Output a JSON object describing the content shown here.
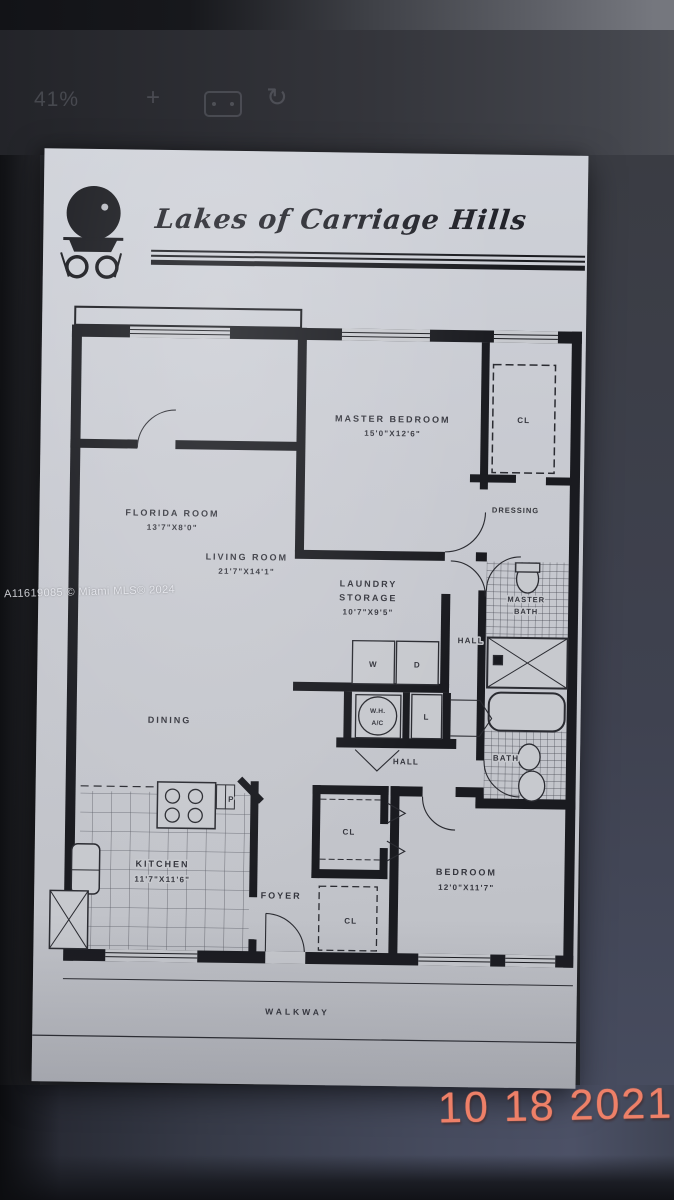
{
  "viewer_toolbar": {
    "zoom_level": "41%",
    "zoom_in_glyph": "+",
    "rotate_glyph": "↻"
  },
  "floorplan": {
    "community": "Lakes of Carriage Hills",
    "watermark": "A11619085 © Miami MLS® 2024",
    "rooms": {
      "florida": {
        "name": "FLORIDA ROOM",
        "dims": "13'7\"X8'0\""
      },
      "master_bedroom": {
        "name": "MASTER BEDROOM",
        "dims": "15'0\"X12'6\""
      },
      "living": {
        "name": "LIVING ROOM",
        "dims": "21'7\"X14'1\""
      },
      "laundry": {
        "line1": "LAUNDRY",
        "line2": "STORAGE",
        "dims": "10'7\"X9'5\""
      },
      "dining": {
        "name": "DINING"
      },
      "kitchen": {
        "name": "KITCHEN",
        "dims": "11'7\"X11'6\""
      },
      "bedroom": {
        "name": "BEDROOM",
        "dims": "12'0\"X11'7\""
      },
      "foyer": {
        "name": "FOYER"
      },
      "dressing": {
        "name": "DRESSING"
      },
      "master_bath": {
        "line1": "MASTER",
        "line2": "BATH"
      },
      "bath": {
        "name": "BATH"
      },
      "hall_upper": "HALL",
      "hall_lower": "HALL",
      "walkway": "WALKWAY"
    },
    "labels": {
      "closet": "CL",
      "washer": "W",
      "dryer": "D",
      "linen": "L",
      "pantry": "P",
      "water_heater": "W.H.",
      "ac": "A/C"
    }
  },
  "photo": {
    "date_stamp": "10 18 2021",
    "date_color": "#ee8068"
  }
}
